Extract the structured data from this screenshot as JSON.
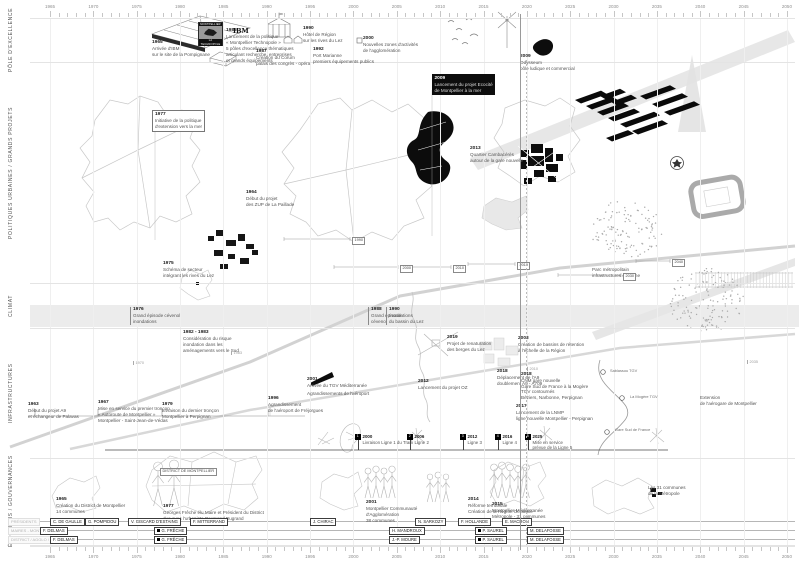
{
  "axis": {
    "x0": 50,
    "dx": 43.35,
    "years": [
      "1965",
      "1970",
      "1975",
      "1980",
      "1985",
      "1990",
      "1995",
      "2000",
      "2005",
      "2010",
      "2015",
      "2020",
      "2025",
      "2030",
      "2035",
      "2040",
      "2045",
      "2050"
    ]
  },
  "present_x": 520,
  "bands": [
    {
      "label": "Pôle d'excellence",
      "y": 18,
      "h": 44
    },
    {
      "label": "Politiques urbaines / Grands projets",
      "y": 62,
      "h": 221
    },
    {
      "label": "Climat",
      "y": 283,
      "h": 45
    },
    {
      "label": "Infrastructures",
      "y": 328,
      "h": 130
    },
    {
      "label": "Élections / Gouvernances",
      "y": 458,
      "h": 87
    }
  ],
  "poster": {
    "line1": "MONTPELLIER",
    "line2": "LA TECHNOPOLE"
  },
  "ibm_label": "IBM",
  "annotations": [
    {
      "x": 152,
      "y": 40,
      "year": "1965",
      "lines": [
        "Arrivée d'IBM",
        "sur le site de la Pompignane"
      ]
    },
    {
      "x": 226,
      "y": 28,
      "year": "1985",
      "lines": [
        "Lancement de la politique",
        "« Montpellier Technopole »",
        "5 pôles d'excellence thématiques",
        "articulant recherche, entreprises",
        "et grands équipements"
      ]
    },
    {
      "x": 256,
      "y": 49,
      "year": "1987",
      "lines": [
        "Création du Corum",
        "palais des congrès - opéra"
      ]
    },
    {
      "x": 303,
      "y": 26,
      "year": "1990",
      "lines": [
        "Hôtel de Région",
        "sur les rives du Lez"
      ]
    },
    {
      "x": 313,
      "y": 47,
      "year": "1992",
      "lines": [
        "Port Marianne",
        "premiers équipements publics"
      ]
    },
    {
      "x": 363,
      "y": 36,
      "year": "2000",
      "lines": [
        "Nouvelles zones d'activités",
        "de l'agglomération"
      ]
    },
    {
      "x": 520,
      "y": 54,
      "year": "2009",
      "lines": [
        "Odysseum",
        "pôle ludique et commercial"
      ]
    },
    {
      "x": 246,
      "y": 190,
      "year": "1964",
      "lines": [
        "Début du projet",
        "des ZUP de La Paillade"
      ]
    },
    {
      "x": 152,
      "y": 110,
      "year": "1977",
      "style": "boxed",
      "lines": [
        "Initiative de la politique",
        "d'extension vers la mer"
      ]
    },
    {
      "x": 432,
      "y": 74,
      "year": "2009",
      "style": "inverted",
      "lines": [
        "Lancement du projet Ecocité",
        "de Montpellier à la mer"
      ]
    },
    {
      "x": 163,
      "y": 261,
      "year": "1975",
      "lines": [
        "Schéma de secteur",
        "intégrant les rives du Lez"
      ]
    },
    {
      "x": 470,
      "y": 146,
      "year": "2013",
      "lines": [
        "Quartier Cambacérès",
        "autour de la gare nouvelle"
      ]
    },
    {
      "x": 592,
      "y": 267,
      "lines": [
        "Parc métropolitain",
        "infrastructures en friche"
      ]
    },
    {
      "x": 130,
      "y": 307,
      "year": "1976",
      "style": "tickline",
      "lines": [
        "Grand épisode cévenol",
        "inondations"
      ]
    },
    {
      "x": 368,
      "y": 307,
      "year": "1988",
      "style": "tickline",
      "lines": [
        "Grand épisode",
        "cévenol"
      ]
    },
    {
      "x": 386,
      "y": 307,
      "year": "1990",
      "style": "tickline",
      "lines": [
        "Inondations",
        "du bassin du Lez"
      ]
    },
    {
      "x": 183,
      "y": 330,
      "year": "1982 - 1983",
      "lines": [
        "Considération du risque",
        "inondation dans les",
        "aménagements vers le Sud"
      ]
    },
    {
      "x": 447,
      "y": 335,
      "year": "2019",
      "lines": [
        "Projet de renaturation",
        "des berges du Lez"
      ]
    },
    {
      "x": 518,
      "y": 336,
      "year": "2003",
      "lines": [
        "Création de bassins de rétention",
        "à l'échelle de la Région"
      ]
    },
    {
      "x": 28,
      "y": 402,
      "year": "1963",
      "lines": [
        "Début du projet A9",
        "et échangeur de Palavas"
      ]
    },
    {
      "x": 98,
      "y": 400,
      "year": "1967",
      "lines": [
        "Mise en service du premier tronçon",
        "« Autoroute de Montpellier »",
        "Montpellier - Saint-Jean-de-Védas"
      ]
    },
    {
      "x": 162,
      "y": 402,
      "year": "1979",
      "lines": [
        "Livraison du dernier tronçon",
        "Montpellier à Perpignan"
      ]
    },
    {
      "x": 268,
      "y": 396,
      "year": "1996",
      "lines": [
        "Agrandissement",
        "de l'aéroport de Fréjorgues"
      ]
    },
    {
      "x": 307,
      "y": 377,
      "year": "2001",
      "lines": [
        "Arrivée du TGV Méditerranée"
      ]
    },
    {
      "x": 307,
      "y": 391,
      "lines": [
        "Agrandissements de l'aéroport"
      ]
    },
    {
      "x": 418,
      "y": 379,
      "year": "2012",
      "lines": [
        "Lancement du projet OZ"
      ]
    },
    {
      "x": 497,
      "y": 369,
      "year": "2018",
      "lines": [
        "Déplacement de l'A9",
        "doublement A9 - A709"
      ]
    },
    {
      "x": 521,
      "y": 372,
      "year": "2018",
      "lines": [
        "CNM gare nouvelle",
        "Gare Sud de France à la Mogère"
      ]
    },
    {
      "x": 521,
      "y": 389,
      "lines": [
        "TGV contournés",
        "Béziers, Narbonne, Perpignan"
      ]
    },
    {
      "x": 516,
      "y": 404,
      "year": "2017",
      "lines": [
        "Lancement de la LNMP",
        "ligne nouvelle Montpellier - Perpignan"
      ]
    },
    {
      "x": 700,
      "y": 395,
      "lines": [
        "Extension",
        "de l'aérogare de Montpellier"
      ]
    },
    {
      "x": 56,
      "y": 497,
      "year": "1965",
      "lines": [
        "Création du District de Montpellier",
        "14 communes"
      ]
    },
    {
      "x": 163,
      "y": 504,
      "year": "1977",
      "lines": [
        "Georges Frêche élu Maire et Président du District",
        "duo avec l'urbaniste Raymond Dugrand"
      ]
    },
    {
      "x": 366,
      "y": 500,
      "year": "2001",
      "lines": [
        "Montpellier Communauté",
        "d'Agglomération",
        "38 communes"
      ]
    },
    {
      "x": 468,
      "y": 497,
      "year": "2014",
      "lines": [
        "Réforme territoriale",
        "Création de la Région Occitanie"
      ]
    },
    {
      "x": 492,
      "y": 502,
      "year": "2015",
      "lines": [
        "Montpellier Méditerranée",
        "Métropole - 31 communes"
      ]
    },
    {
      "x": 648,
      "y": 485,
      "lines": [
        "Les 31 communes",
        "de la Métropole"
      ]
    }
  ],
  "chips": [
    {
      "x": 352,
      "y": 237,
      "label": "1990"
    },
    {
      "x": 400,
      "y": 265,
      "label": "2000"
    },
    {
      "x": 453,
      "y": 265,
      "label": "2010"
    },
    {
      "x": 517,
      "y": 262,
      "label": "2019"
    },
    {
      "x": 623,
      "y": 273,
      "label": "2030"
    },
    {
      "x": 672,
      "y": 259,
      "label": "2040"
    },
    {
      "x": 160,
      "y": 468,
      "label": "DISTRICT DE MONTPELLIER"
    }
  ],
  "brackets": [
    {
      "x1": 284,
      "x2": 350,
      "y": 239
    },
    {
      "x1": 334,
      "x2": 398,
      "y": 267
    },
    {
      "x1": 410,
      "x2": 451,
      "y": 267
    },
    {
      "x1": 468,
      "x2": 515,
      "y": 264
    },
    {
      "x1": 558,
      "x2": 621,
      "y": 275
    },
    {
      "x1": 636,
      "x2": 670,
      "y": 261
    }
  ],
  "road_ticks": [
    {
      "x": 133,
      "y": 361,
      "label": "1970"
    },
    {
      "x": 231,
      "y": 351,
      "label": "1983"
    },
    {
      "x": 527,
      "y": 367,
      "label": "2010"
    },
    {
      "x": 747,
      "y": 360,
      "label": "2035"
    }
  ],
  "stations": [
    {
      "x": 610,
      "y": 368,
      "label": "Sablassou TGV"
    },
    {
      "x": 630,
      "y": 394,
      "label": "La Mogère TGV"
    },
    {
      "x": 615,
      "y": 427,
      "label": "Gare Sud de France"
    }
  ],
  "tram_row": {
    "y_line": 450,
    "x1": 105,
    "x2": 668,
    "y_marker": 434,
    "markers": [
      {
        "x": 355,
        "chip": "1",
        "year": "2000",
        "lines": [
          "Livraison Ligne 1 du Tram"
        ]
      },
      {
        "x": 407,
        "chip": "2",
        "year": "2006",
        "lines": [
          "Ligne 2"
        ]
      },
      {
        "x": 460,
        "chip": "3",
        "year": "2012",
        "lines": [
          "Ligne 3"
        ]
      },
      {
        "x": 495,
        "chip": "4",
        "year": "2016",
        "lines": [
          "Ligne 4"
        ]
      },
      {
        "x": 525,
        "chip": "5",
        "year": "2025",
        "lines": [
          "Mise en service",
          "prévue de la Ligne 5"
        ]
      }
    ]
  },
  "rows": [
    {
      "label": "PRÉSIDENTS",
      "y": 518,
      "segments": [
        {
          "x": 50,
          "label": "C. DE GAULLE"
        },
        {
          "x": 85,
          "label": "G. POMPIDOU"
        },
        {
          "x": 128,
          "label": "V. GISCARD D'ESTAING"
        },
        {
          "x": 190,
          "label": "F. MITTERRAND"
        },
        {
          "x": 310,
          "label": "J. CHIRAC"
        },
        {
          "x": 415,
          "label": "N. SARKOZY"
        },
        {
          "x": 458,
          "label": "F. HOLLANDE"
        },
        {
          "x": 502,
          "label": "E. MACRON"
        }
      ]
    },
    {
      "label": "MAIRES - MONTPELLIER",
      "y": 527,
      "segments": [
        {
          "x": 40,
          "label": "F. DELMAS"
        },
        {
          "x": 154,
          "label": "G. FRÊCHE",
          "marker": true
        },
        {
          "x": 389,
          "label": "H. MANDROUX"
        },
        {
          "x": 475,
          "label": "P. SAUREL",
          "marker": true
        },
        {
          "x": 527,
          "label": "M. DELAFOSSE"
        }
      ]
    },
    {
      "label": "DISTRICT / AGGLO / MÉTROPOLE",
      "y": 536,
      "segments": [
        {
          "x": 50,
          "label": "F. DELMAS"
        },
        {
          "x": 154,
          "label": "G. FRÊCHE",
          "marker": true
        },
        {
          "x": 389,
          "label": "J.-P. MOURE"
        },
        {
          "x": 475,
          "label": "P. SAUREL",
          "marker": true
        },
        {
          "x": 527,
          "label": "M. DELAFOSSE"
        }
      ]
    }
  ]
}
